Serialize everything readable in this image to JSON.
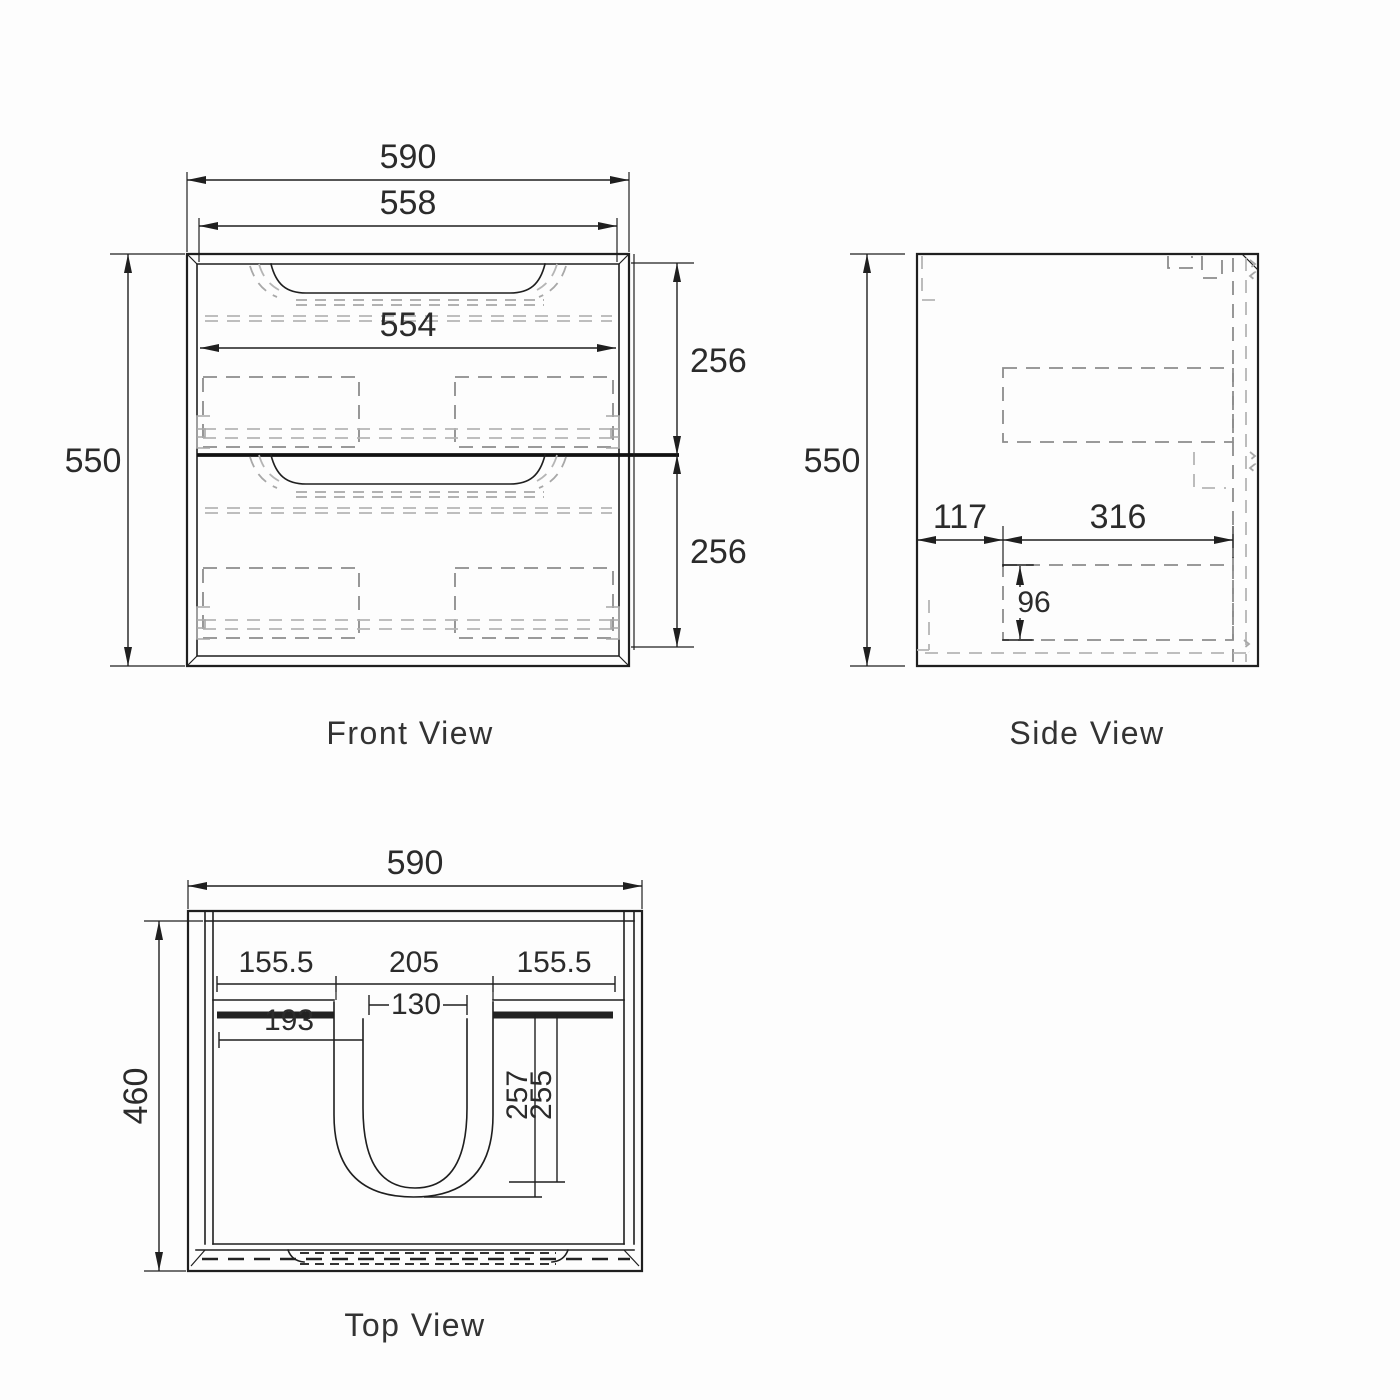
{
  "document": {
    "type": "cabinet-dimension-drawing",
    "background": "#fdfdfd",
    "colors": {
      "line": "#1f1f1f",
      "hidden_dash_dark": "#8c8c8c",
      "hidden_dash_light": "#b5b5b5",
      "text": "#2b2b2b"
    }
  },
  "views": {
    "front": {
      "title": "Front View",
      "dims": {
        "overall_width": "590",
        "inner_width": "558",
        "drawer_face_width": "554",
        "overall_height": "550",
        "upper_drawer_height": "256",
        "lower_drawer_height": "256"
      }
    },
    "side": {
      "title": "Side View",
      "dims": {
        "overall_height": "550",
        "front_offset": "117",
        "drawer_box_depth": "316",
        "drawer_box_height": "96"
      }
    },
    "top": {
      "title": "Top View",
      "dims": {
        "overall_width": "590",
        "overall_depth": "460",
        "counter_left": "155.5",
        "basin_cutout": "205",
        "counter_right": "155.5",
        "basin_top_width": "130",
        "counter_recess": "193",
        "basin_depth_outer": "257",
        "basin_depth_inner": "255"
      }
    }
  }
}
